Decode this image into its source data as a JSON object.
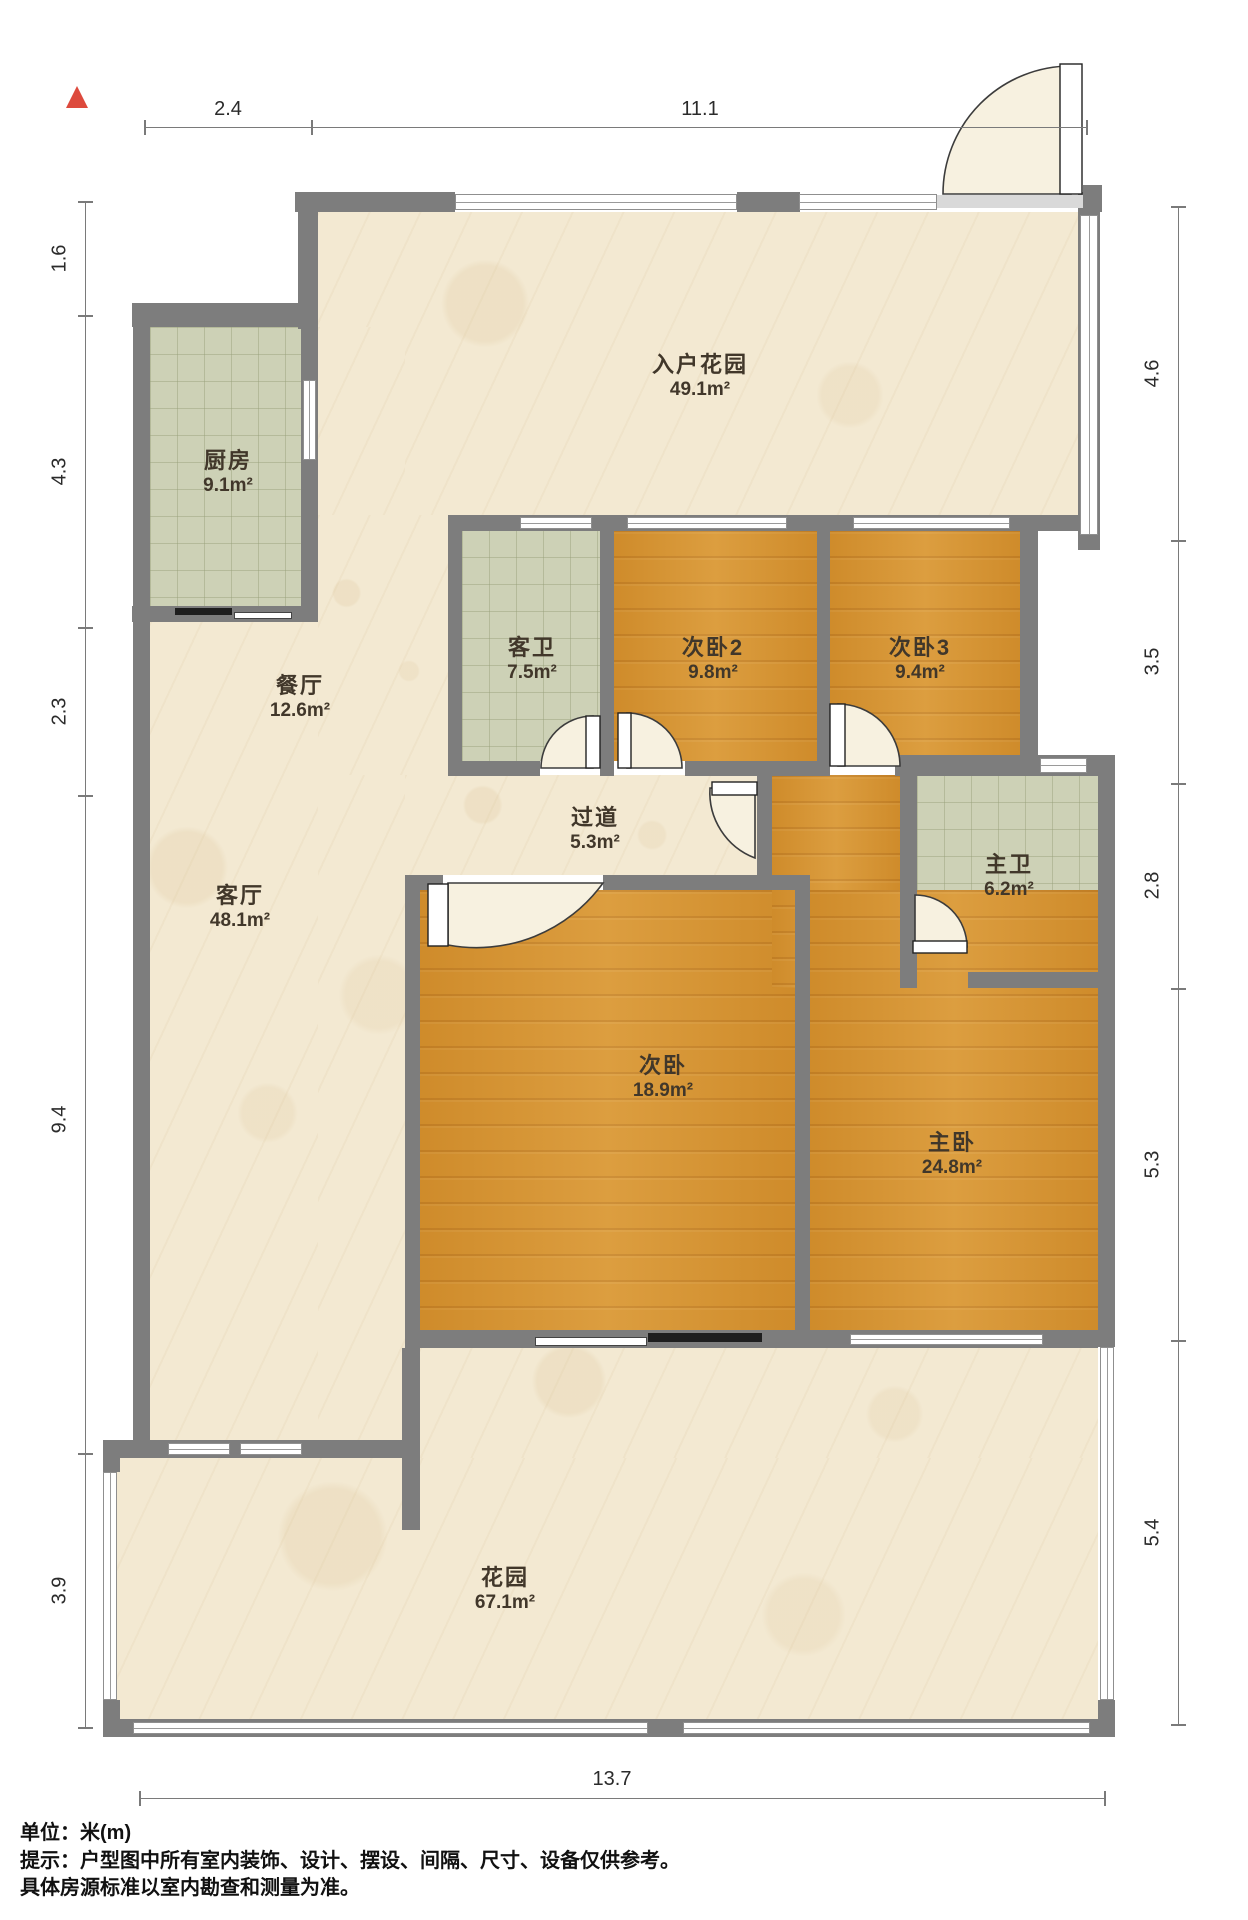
{
  "north_arrow": {
    "label": "north",
    "color": "#dd4a3d"
  },
  "dimensions": {
    "top": [
      "2.4",
      "11.1"
    ],
    "left": [
      "1.6",
      "4.3",
      "2.3",
      "9.4",
      "3.9"
    ],
    "right": [
      "4.6",
      "3.5",
      "2.8",
      "5.3",
      "5.4"
    ],
    "bottom": [
      "13.7"
    ]
  },
  "rooms": {
    "entry_garden": {
      "name": "入户花园",
      "area": "49.1m²"
    },
    "kitchen": {
      "name": "厨房",
      "area": "9.1m²"
    },
    "dining": {
      "name": "餐厅",
      "area": "12.6m²"
    },
    "guest_bath": {
      "name": "客卫",
      "area": "7.5m²"
    },
    "bedroom2": {
      "name": "次卧2",
      "area": "9.8m²"
    },
    "bedroom3": {
      "name": "次卧3",
      "area": "9.4m²"
    },
    "hallway": {
      "name": "过道",
      "area": "5.3m²"
    },
    "master_bath": {
      "name": "主卫",
      "area": "6.2m²"
    },
    "living": {
      "name": "客厅",
      "area": "48.1m²"
    },
    "bedroom": {
      "name": "次卧",
      "area": "18.9m²"
    },
    "master_bedroom": {
      "name": "主卧",
      "area": "24.8m²"
    },
    "garden": {
      "name": "花园",
      "area": "67.1m²"
    }
  },
  "footer": {
    "unit": "单位：米(m)",
    "tip1": "提示：户型图中所有室内装饰、设计、摆设、间隔、尺寸、设备仅供参考。",
    "tip2": "具体房源标准以室内勘查和测量为准。"
  },
  "colors": {
    "wall": "#7d7d7d",
    "floor_beige": "#f3e9d2",
    "floor_tile": "#cdd1b6",
    "floor_wood": "#d89530",
    "north_arrow": "#dd4a3d"
  }
}
